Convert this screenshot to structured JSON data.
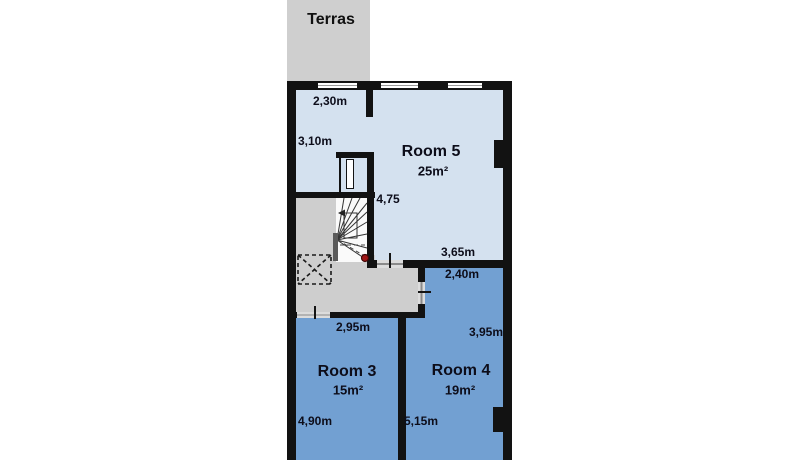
{
  "terrace": {
    "label": "Terras"
  },
  "floor": {
    "room5": {
      "name": "Room 5",
      "area": "25m²",
      "dim_top_width": "2,30m",
      "dim_left_height": "3,10m",
      "dim_stair_height": "4,75",
      "dim_bottom_width": "3,65m"
    },
    "room4": {
      "name": "Room 4",
      "area": "19m²",
      "dim_top_width": "2,40m",
      "dim_right_height": "3,95m",
      "dim_left_height": "5,15m"
    },
    "room3": {
      "name": "Room 3",
      "area": "15m²",
      "dim_top_width": "2,95m",
      "dim_left_height": "4,90m"
    }
  },
  "icons": {
    "red_marker": "red-dot-marker",
    "void_box": "dashed-void-box",
    "staircase": "winder-staircase"
  },
  "colors": {
    "wall": "#121212",
    "room5_fill": "#d4e1ef",
    "room34_fill": "#72a0d2",
    "hall_fill": "#cecece",
    "terrace_fill": "#cfcfcf",
    "stairs_fill": "#fafafa",
    "marker_red": "#a01616"
  }
}
